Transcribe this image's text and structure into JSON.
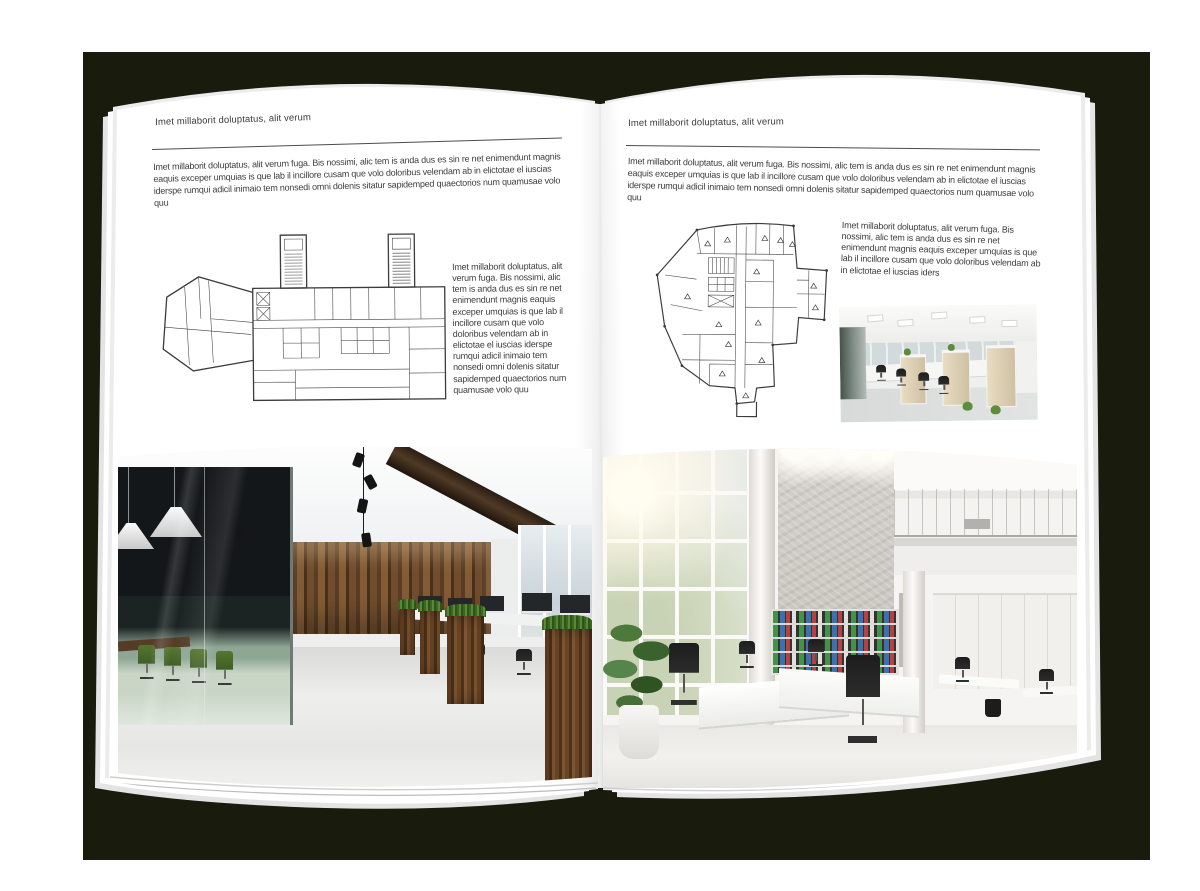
{
  "document": {
    "backdrop_color": "#191b0c",
    "page_color": "#ffffff",
    "text_color": "#3e3e3e",
    "rule_color": "#4c4c4c",
    "plan_line_color": "#3c3c3c"
  },
  "left_page": {
    "header": "Imet millaborit doluptatus, alit verum",
    "intro": "Imet millaborit doluptatus, alit verum fuga. Bis nossimi, alic tem is anda dus es sin re net enimendunt magnis eaquis exceper umquias is que lab il incillore cusam que volo doloribus velendam ab in elictotae el iuscias iderspe rumqui adicil inimaio tem nonsedi omni dolenis sitatur sapidemped quaectorios num quamusae volo quu",
    "side_text": "Imet millaborit doluptatus, alit verum fuga. Bis nossimi, alic tem is anda dus es sin re net enimendunt magnis eaquis exceper umquias is que lab il incillore cusam que volo doloribus velendam ab in elictotae el iuscias iderspe rumqui adicil inimaio tem nonsedi omni dolenis sitatur sapidemped quaectorios num quamusae volo quu"
  },
  "right_page": {
    "header": "Imet millaborit doluptatus, alit verum",
    "intro": "Imet millaborit doluptatus, alit verum fuga. Bis nossimi, alic tem is anda dus es sin re net enimendunt magnis eaquis exceper umquias is que lab il incillore cusam que volo doloribus velendam ab in elictotae el iuscias iderspe rumqui adicil inimaio tem nonsedi omni dolenis sitatur sapidemped quaectorios num quamusae volo quu",
    "side_text": "Imet millaborit doluptatus, alit verum fuga. Bis nossimi, alic tem is anda dus es sin re net enimendunt magnis eaquis exceper umquias is que lab il incillore cusam que volo doloribus velendam ab in elictotae el iuscias iders"
  }
}
